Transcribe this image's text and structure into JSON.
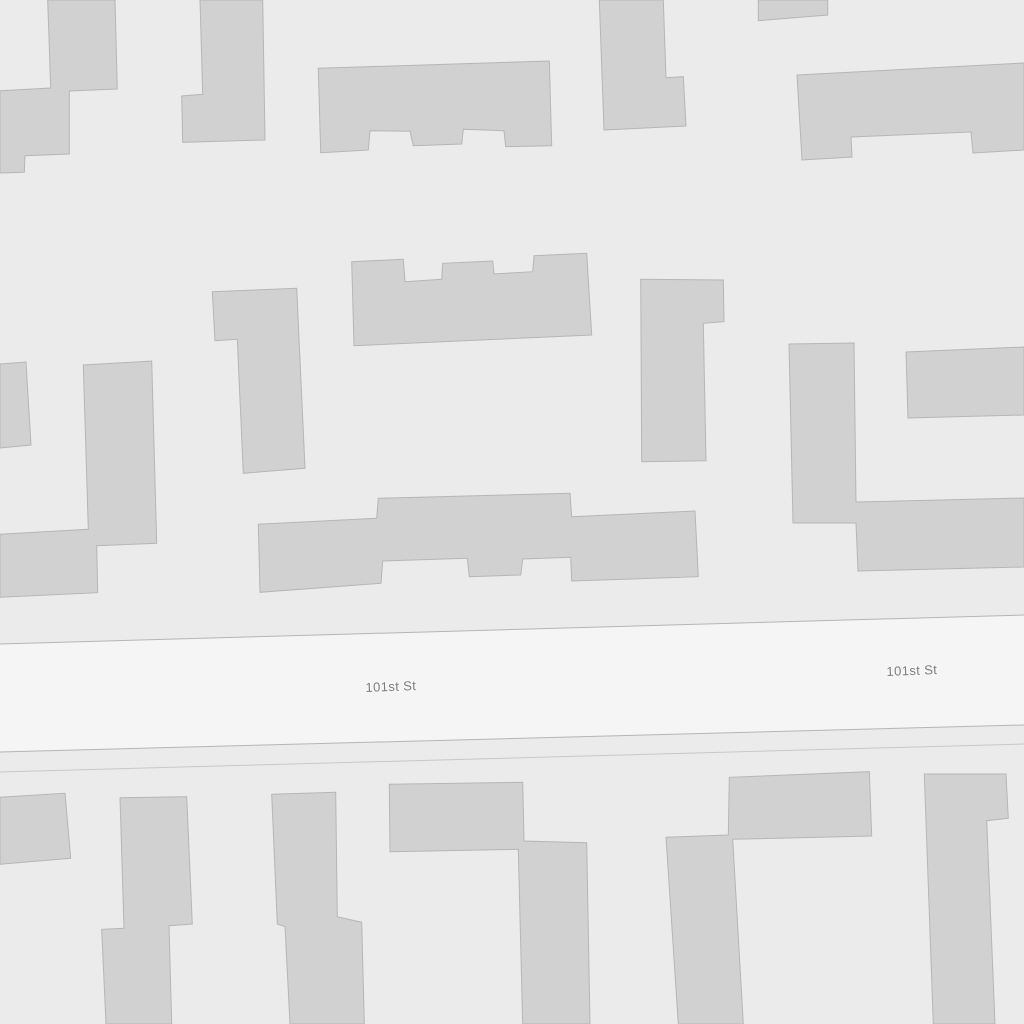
{
  "map": {
    "background_color": "#ebebeb",
    "street": {
      "name": "101st St",
      "fill": "#f5f5f5",
      "casing_color": "#b5b5b5",
      "secondary_line_color": "#c8c8c8",
      "band": [
        [
          0,
          644
        ],
        [
          1024,
          615
        ],
        [
          1024,
          725
        ],
        [
          0,
          752
        ]
      ],
      "secondary_line": [
        [
          0,
          772
        ],
        [
          1024,
          744
        ]
      ],
      "label_color": "#7d7d7d",
      "label_halo": "#f7f7f7",
      "label_font_size": 13,
      "labels": [
        {
          "text": "101st St",
          "x": 391,
          "y": 691,
          "rotate": -2.2
        },
        {
          "text": "101st St",
          "x": 912,
          "y": 675,
          "rotate": -2.2
        }
      ]
    },
    "buildings": {
      "fill": "#d1d1d1",
      "stroke": "#b6b6b6",
      "footprints": [
        {
          "id": "building-top-left",
          "points": [
            [
              47.7,
              0
            ],
            [
              115,
              0
            ],
            [
              117.3,
              89
            ],
            [
              69.3,
              91
            ],
            [
              69.3,
              154
            ],
            [
              25,
              155.7
            ],
            [
              24.3,
              172.3
            ],
            [
              0,
              173
            ],
            [
              0,
              90.7
            ],
            [
              50.7,
              88
            ]
          ]
        },
        {
          "id": "building-top-column-left",
          "points": [
            [
              200,
              0
            ],
            [
              262.7,
              0
            ],
            [
              265,
              140
            ],
            [
              182.7,
              142.3
            ],
            [
              181.7,
              96
            ],
            [
              202.7,
              94.3
            ]
          ]
        },
        {
          "id": "building-top-center",
          "points": [
            [
              318.3,
              68.3
            ],
            [
              549.3,
              61
            ],
            [
              551.7,
              145.7
            ],
            [
              505.7,
              146.7
            ],
            [
              504,
              130.7
            ],
            [
              463.3,
              129.3
            ],
            [
              461.7,
              144
            ],
            [
              413.3,
              145.7
            ],
            [
              410,
              131.3
            ],
            [
              370,
              130.7
            ],
            [
              368.3,
              150
            ],
            [
              320.7,
              152.7
            ]
          ]
        },
        {
          "id": "building-top-column-right",
          "points": [
            [
              599.3,
              0
            ],
            [
              663.3,
              0
            ],
            [
              666,
              77.7
            ],
            [
              683.3,
              76.7
            ],
            [
              686,
              126
            ],
            [
              604,
              130
            ]
          ]
        },
        {
          "id": "building-top-small-rect",
          "points": [
            [
              758.3,
              0
            ],
            [
              827.7,
              0
            ],
            [
              827.7,
              15
            ],
            [
              758.3,
              20.7
            ]
          ]
        },
        {
          "id": "building-top-right",
          "points": [
            [
              797,
              75
            ],
            [
              1024,
              63
            ],
            [
              1024,
              150
            ],
            [
              973,
              153
            ],
            [
              971,
              132
            ],
            [
              851,
              137
            ],
            [
              852,
              157
            ],
            [
              802,
              160
            ]
          ]
        },
        {
          "id": "building-left-edge-small",
          "points": [
            [
              0,
              364
            ],
            [
              26,
              362
            ],
            [
              31,
              445
            ],
            [
              0,
              448
            ]
          ]
        },
        {
          "id": "building-mid-left-l-shape",
          "points": [
            [
              83.3,
              365
            ],
            [
              151.7,
              361
            ],
            [
              156.7,
              543.3
            ],
            [
              96.7,
              545.7
            ],
            [
              97.7,
              592.7
            ],
            [
              0,
              597.3
            ],
            [
              0,
              534.3
            ],
            [
              88.3,
              529.3
            ]
          ]
        },
        {
          "id": "building-mid-bar-notched",
          "points": [
            [
              212.3,
              291.7
            ],
            [
              296.7,
              288.3
            ],
            [
              305,
              468.3
            ],
            [
              243.3,
              473.3
            ],
            [
              237.3,
              339.3
            ],
            [
              215,
              340.7
            ]
          ]
        },
        {
          "id": "building-mid-center",
          "points": [
            [
              351.7,
              261.7
            ],
            [
              403.3,
              259.3
            ],
            [
              405,
              281.7
            ],
            [
              441.7,
              279.3
            ],
            [
              442.7,
              263.3
            ],
            [
              492.7,
              261
            ],
            [
              494,
              274
            ],
            [
              532.7,
              271.7
            ],
            [
              534,
              255.7
            ],
            [
              586.7,
              253.3
            ],
            [
              591.7,
              335
            ],
            [
              354,
              345.7
            ]
          ]
        },
        {
          "id": "building-mid-right-bar",
          "points": [
            [
              640.7,
              279.3
            ],
            [
              723.3,
              280
            ],
            [
              724,
              321.7
            ],
            [
              703.3,
              323.3
            ],
            [
              706,
              460.7
            ],
            [
              641.7,
              461.7
            ]
          ]
        },
        {
          "id": "building-right-l-shape",
          "points": [
            [
              789,
              344
            ],
            [
              854,
              343
            ],
            [
              856,
              502
            ],
            [
              1024,
              498
            ],
            [
              1024,
              567
            ],
            [
              858,
              571
            ],
            [
              856,
              523
            ],
            [
              793,
              523
            ]
          ]
        },
        {
          "id": "building-right-edge-rect",
          "points": [
            [
              906,
              352
            ],
            [
              1024,
              347
            ],
            [
              1024,
              415
            ],
            [
              908,
              418
            ]
          ]
        },
        {
          "id": "building-center-long",
          "points": [
            [
              258.3,
              524.3
            ],
            [
              376.7,
              518.3
            ],
            [
              378.3,
              498.3
            ],
            [
              570,
              493.3
            ],
            [
              571.7,
              516.7
            ],
            [
              695,
              511
            ],
            [
              698.3,
              576.7
            ],
            [
              571.7,
              581
            ],
            [
              570.7,
              557.3
            ],
            [
              522.7,
              559
            ],
            [
              520.7,
              575
            ],
            [
              469.3,
              576.7
            ],
            [
              467.3,
              558.3
            ],
            [
              382.7,
              561
            ],
            [
              381,
              583.3
            ],
            [
              260,
              592.3
            ]
          ]
        },
        {
          "id": "building-bottom-left-small",
          "points": [
            [
              0,
              797.3
            ],
            [
              65,
              793.3
            ],
            [
              70.7,
              858.3
            ],
            [
              0,
              864.3
            ]
          ]
        },
        {
          "id": "building-bottom-left-tall",
          "points": [
            [
              120,
              797.7
            ],
            [
              186.7,
              796.7
            ],
            [
              192.3,
              924
            ],
            [
              169,
              925.7
            ],
            [
              171.7,
              1024
            ],
            [
              106,
              1024
            ],
            [
              101.7,
              929.3
            ],
            [
              124,
              928.3
            ]
          ]
        },
        {
          "id": "building-bottom-bar",
          "points": [
            [
              271.7,
              794.3
            ],
            [
              335.7,
              792.3
            ],
            [
              337.3,
              916.7
            ],
            [
              361.7,
              922.3
            ],
            [
              364.3,
              1024
            ],
            [
              290,
              1024
            ],
            [
              285,
              926.7
            ],
            [
              277.3,
              924
            ]
          ]
        },
        {
          "id": "building-bottom-center-l",
          "points": [
            [
              389.3,
              784.3
            ],
            [
              522.7,
              782.3
            ],
            [
              524,
              841
            ],
            [
              586.7,
              842.7
            ],
            [
              590,
              1024
            ],
            [
              522.7,
              1024
            ],
            [
              518.3,
              849.3
            ],
            [
              390,
              851.7
            ]
          ]
        },
        {
          "id": "building-bottom-gamma",
          "points": [
            [
              666,
              837.3
            ],
            [
              728.3,
              835
            ],
            [
              729.3,
              777.3
            ],
            [
              869.3,
              771.7
            ],
            [
              871.7,
              836
            ],
            [
              732.7,
              839.3
            ],
            [
              743.3,
              1024
            ],
            [
              678.3,
              1024
            ]
          ]
        },
        {
          "id": "building-bottom-right",
          "points": [
            [
              924.3,
              774
            ],
            [
              1006,
              774
            ],
            [
              1008.3,
              818.3
            ],
            [
              986.7,
              820.7
            ],
            [
              995,
              1024
            ],
            [
              933.3,
              1024
            ]
          ]
        }
      ]
    }
  }
}
